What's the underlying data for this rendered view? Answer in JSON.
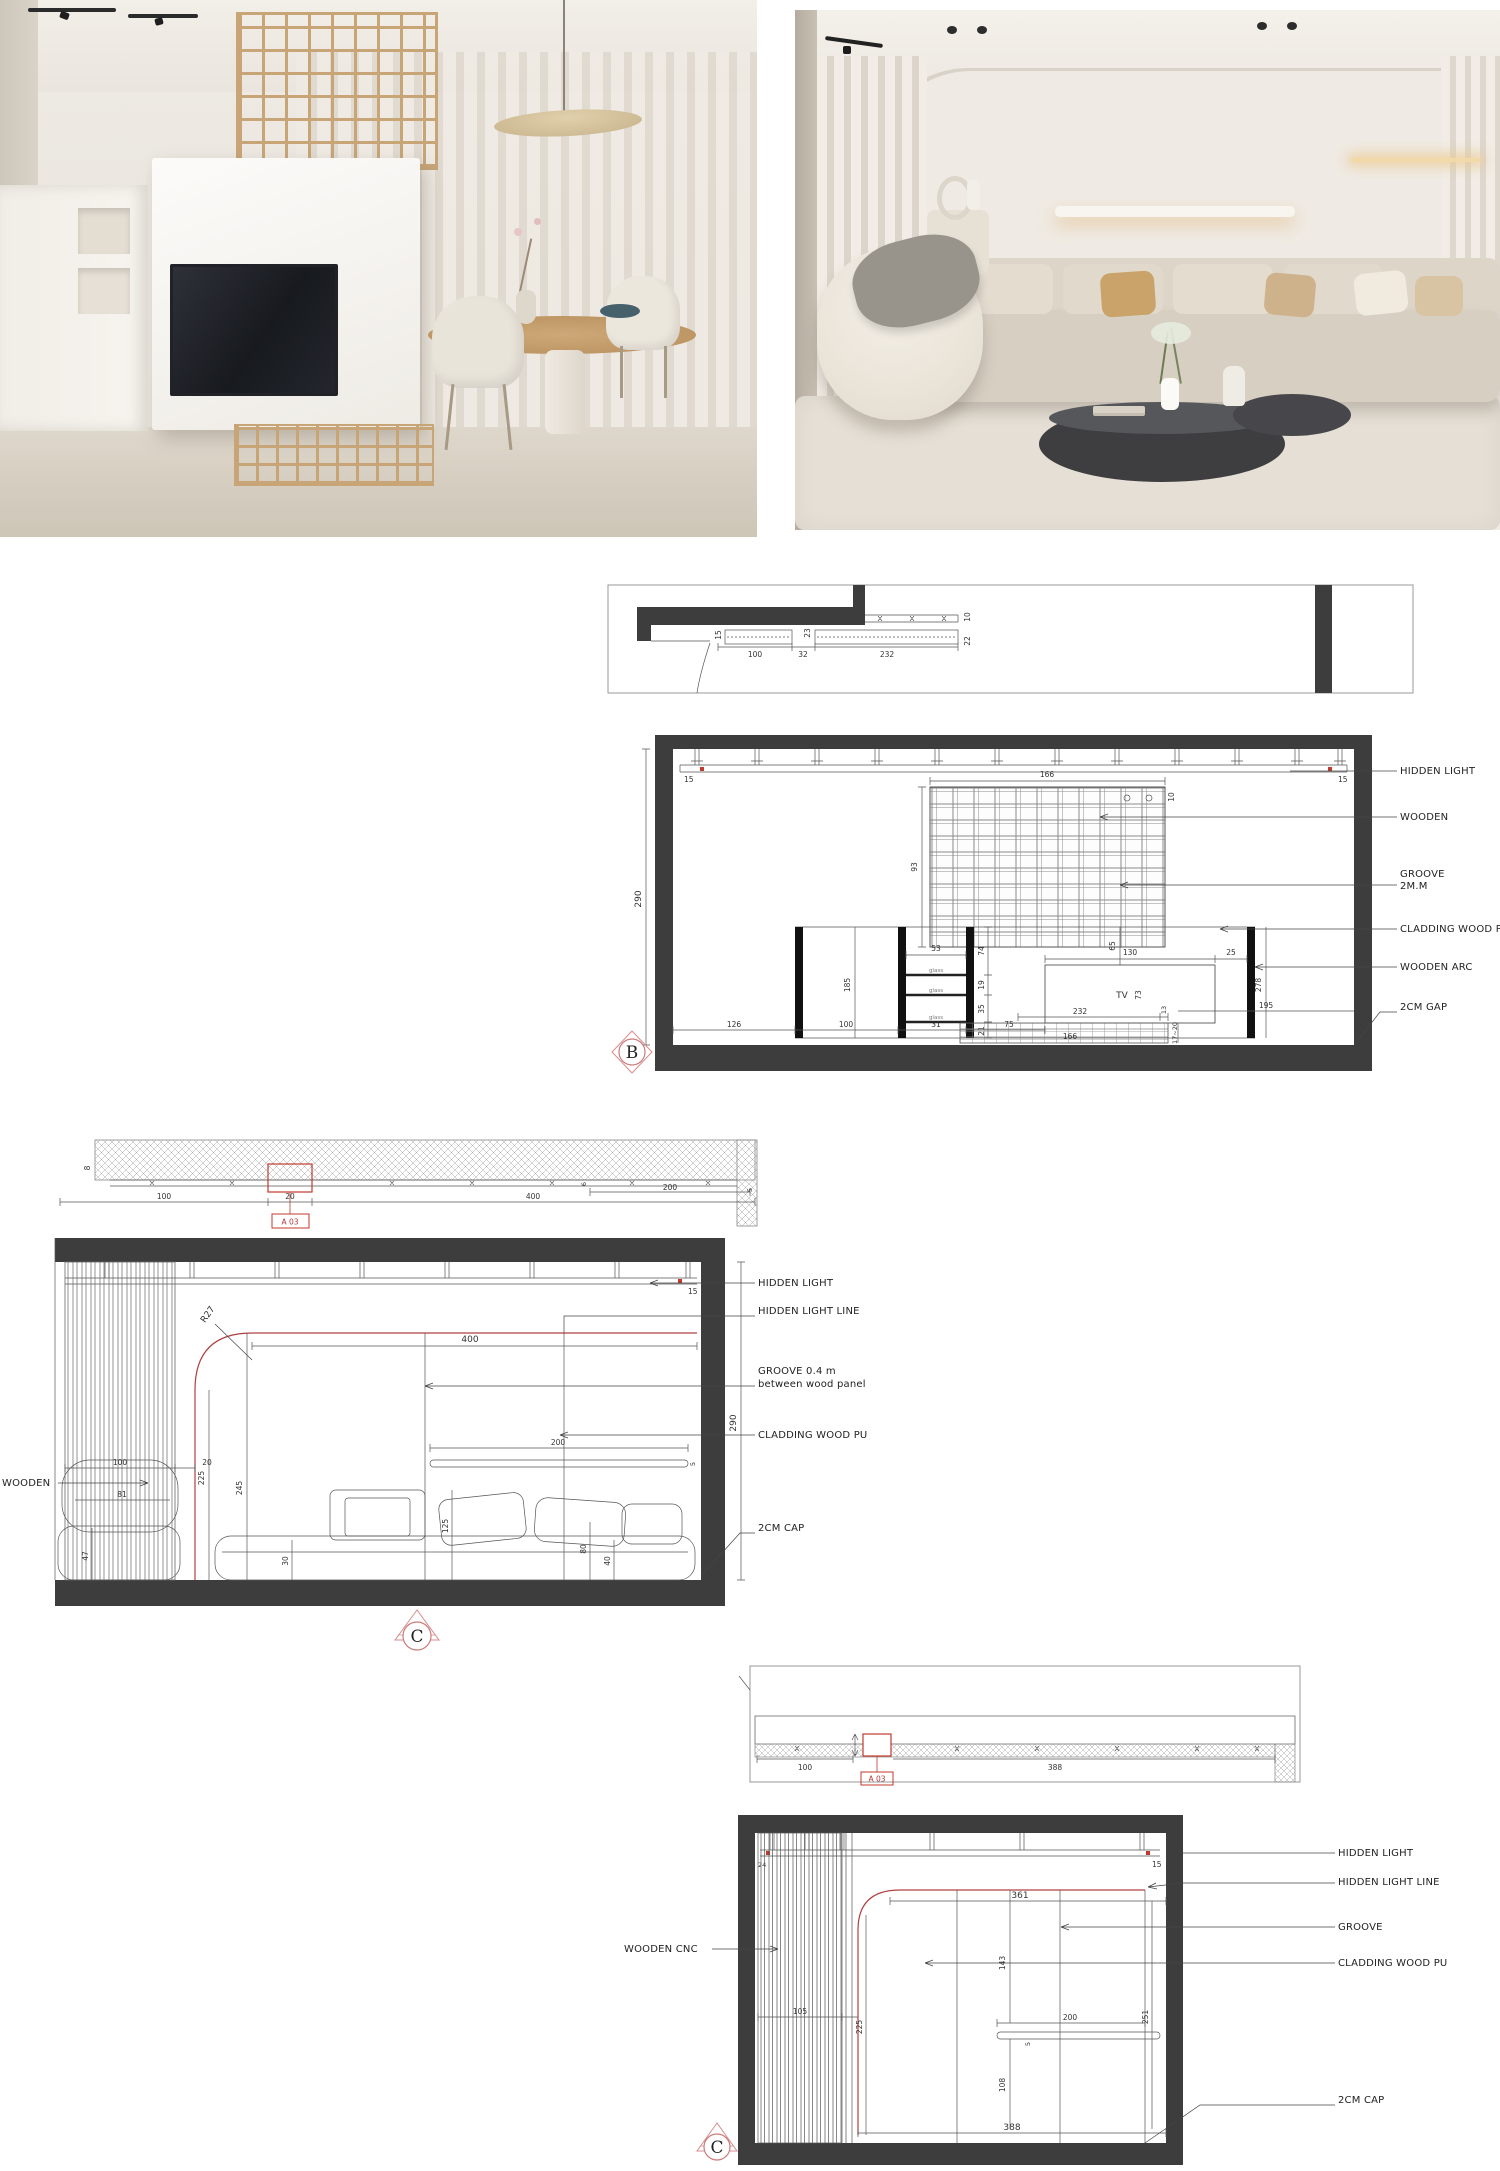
{
  "colors": {
    "line": "#4a4a4a",
    "wall_fill": "#3d3d3d",
    "accent_red": "#b03a3a",
    "wood": "#c9a678",
    "cream": "#ece7e0"
  },
  "plan_top": {
    "dims": {
      "d15": "15",
      "d100": "100",
      "d23": "23",
      "d32": "32",
      "d232": "232",
      "d22": "22",
      "d10": "10"
    }
  },
  "elevation_b": {
    "marker": "B",
    "dims": {
      "d290": "290",
      "d15l": "15",
      "d15r": "15",
      "d166": "166",
      "d10": "10",
      "d93": "93",
      "d53": "53",
      "d74": "74",
      "d19": "19",
      "d35": "35",
      "d21": "21",
      "d185": "185",
      "d130": "130",
      "d25": "25",
      "d65": "65",
      "d73": "73",
      "d232": "232",
      "d13": "13",
      "d166b": "166",
      "d278": "278",
      "d126": "126",
      "d100": "100",
      "d31": "31",
      "d75": "75",
      "d195": "195",
      "d1720": "17~20"
    },
    "texts": {
      "tv": "TV",
      "glass": "glass"
    },
    "labels": {
      "hidden_light": "HIDDEN LIGHT",
      "wooden": "WOODEN",
      "groove1": "GROOVE",
      "groove2": "2M.M",
      "cladding": "CLADDING WOOD PU",
      "wooden_arc": "WOODEN ARC",
      "gap": "2CM GAP"
    }
  },
  "section_c": {
    "marker": "C",
    "detail_ref": "A 03",
    "radius": "R27",
    "strip_dims": {
      "d8": "8",
      "d100": "100",
      "d20": "20",
      "d400": "400",
      "d200": "200",
      "d6": "6",
      "d5": "5"
    },
    "dims": {
      "d15": "15",
      "d400": "400",
      "d225": "225",
      "d245": "245",
      "d100": "100",
      "d20": "20",
      "d81": "81",
      "d47": "47",
      "d30": "30",
      "d125": "125",
      "d80": "80",
      "d40": "40",
      "d200": "200",
      "d5": "5",
      "d290": "290"
    },
    "labels": {
      "hidden_light": "HIDDEN LIGHT",
      "hidden_light_line": "HIDDEN LIGHT LINE",
      "groove1": "GROOVE 0.4 m",
      "groove2": "between wood panel",
      "cladding": "CLADDING WOOD PU",
      "cap": "2CM CAP",
      "wooden": "WOODEN"
    }
  },
  "plan_bottom": {
    "detail_ref": "A 03",
    "dims": {
      "d100": "100",
      "d388": "388"
    }
  },
  "elevation_c": {
    "marker": "C",
    "dims": {
      "d24": "24",
      "d15": "15",
      "d361": "361",
      "d143": "143",
      "d225": "225",
      "d105": "105",
      "d251": "251",
      "d200": "200",
      "d5": "5",
      "d108": "108",
      "d388": "388"
    },
    "labels": {
      "hidden_light": "HIDDEN LIGHT",
      "hidden_light_line": "HIDDEN LIGHT LINE",
      "groove": "GROOVE",
      "cladding": "CLADDING WOOD PU",
      "cap": "2CM CAP",
      "wooden_cnc": "WOODEN CNC"
    }
  }
}
